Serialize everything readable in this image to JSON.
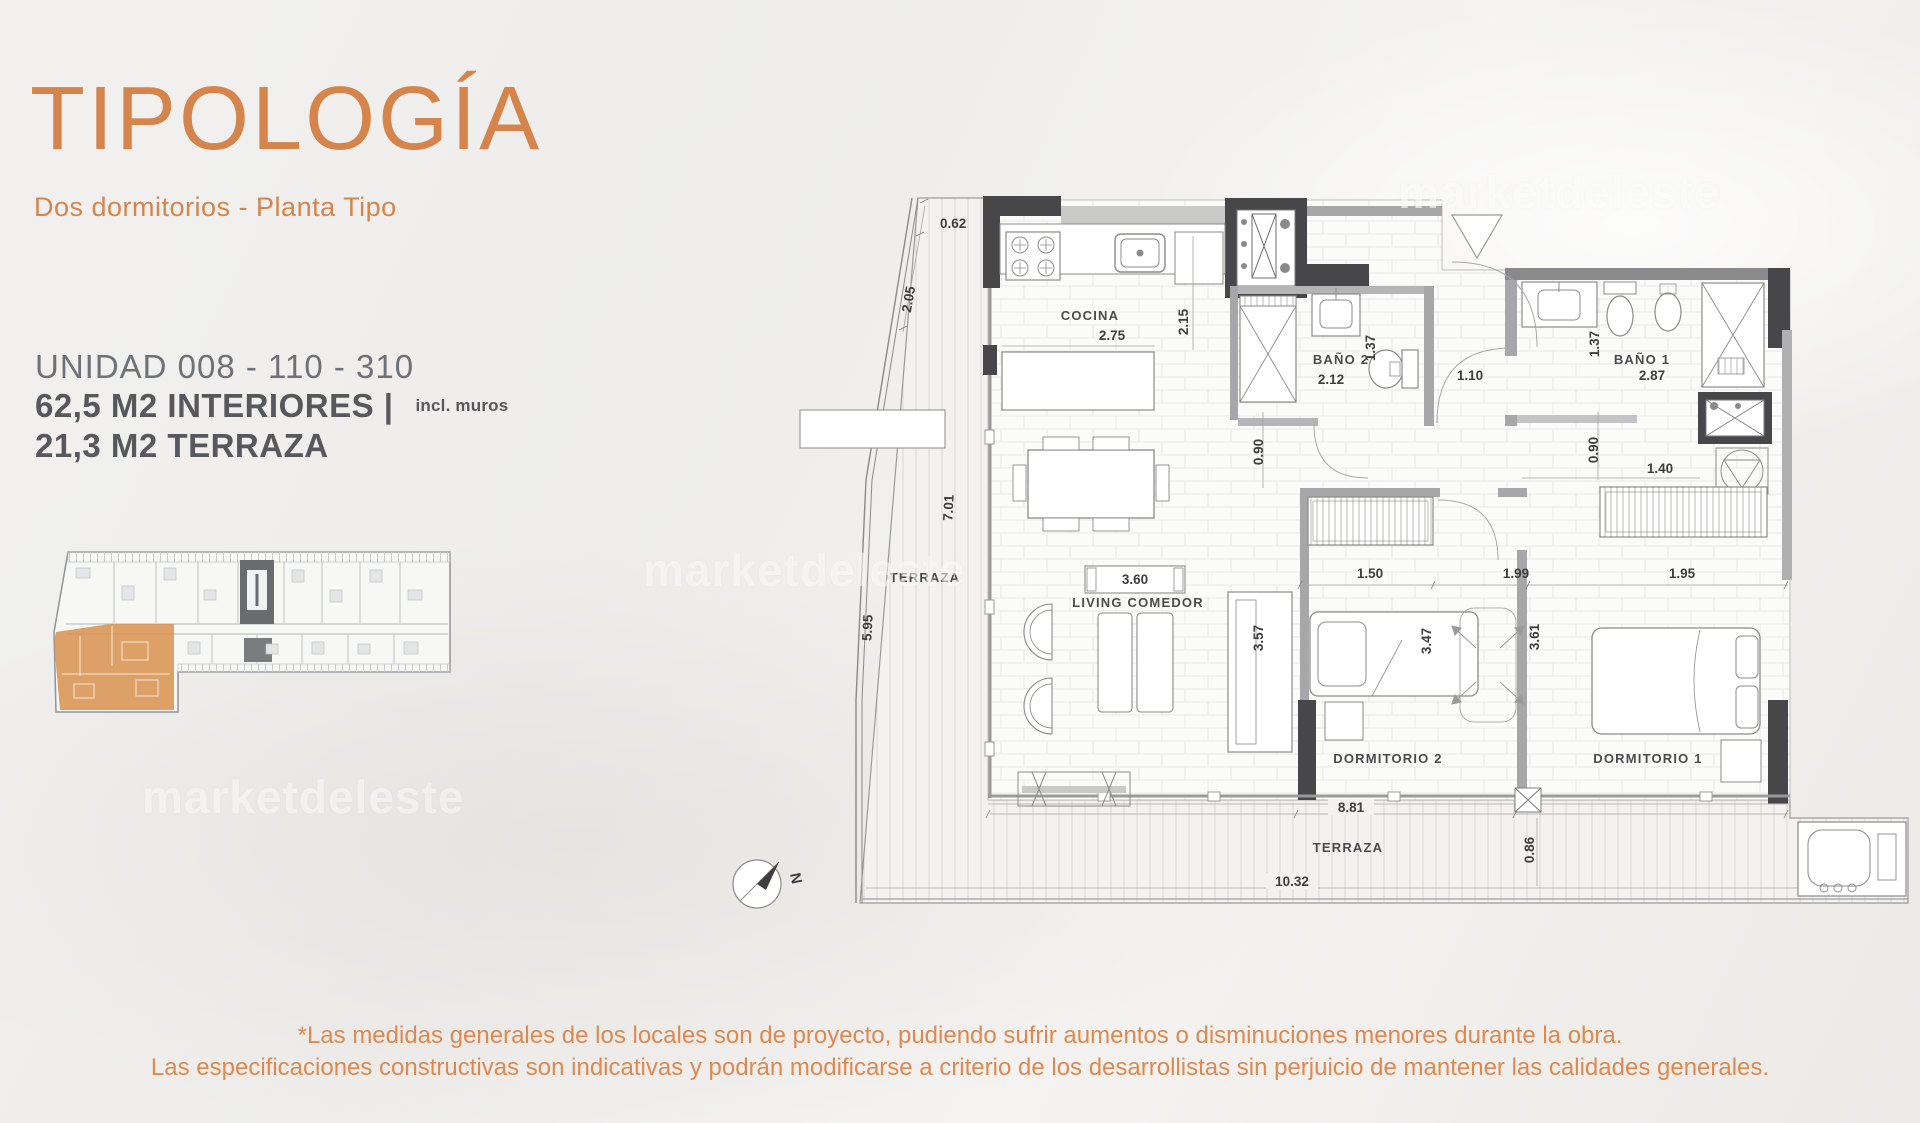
{
  "page": {
    "background": "#f0efec",
    "accent_orange": "#d5854b",
    "text_gray": "#6e7175",
    "bold_gray": "#57585b",
    "wall_dark": "#474749",
    "keyplan_highlight": "#d8914e"
  },
  "header": {
    "title": "TIPOLOGÍA",
    "subtitle": "Dos dormitorios - Planta Tipo"
  },
  "unit": {
    "name": "UNIDAD 008 - 110 - 310",
    "interior": "62,5 M2 INTERIORES |",
    "interior_note": "incl. muros",
    "terrace": "21,3 M2 TERRAZA"
  },
  "watermark": {
    "text": "marketdeleste"
  },
  "plan": {
    "rooms": {
      "cocina": "COCINA",
      "bano2": "BAÑO 2",
      "bano1": "BAÑO 1",
      "living": "LIVING COMEDOR",
      "terraza_left": "TERRAZA",
      "dorm2": "DORMITORIO 2",
      "dorm1": "DORMITORIO 1",
      "terraza_bottom": "TERRAZA"
    },
    "dims": {
      "d062": "0.62",
      "d205": "2.05",
      "d701": "7.01",
      "d595": "5.95",
      "d275": "2.75",
      "d215": "2.15",
      "d212": "2.12",
      "d137a": "1.37",
      "d110": "1.10",
      "d287": "2.87",
      "d137b": "1.37",
      "d090a": "0.90",
      "d090b": "0.90",
      "d140": "1.40",
      "d360": "3.60",
      "d150": "1.50",
      "d199": "1.99",
      "d195": "1.95",
      "d357": "3.57",
      "d347": "3.47",
      "d361": "3.61",
      "d881": "8.81",
      "d086": "0.86",
      "d125": "1.25",
      "d1032": "10.32"
    },
    "north": "N"
  },
  "disclaimer": {
    "line1": "*Las medidas generales de los locales son de proyecto, pudiendo sufrir aumentos o disminuciones menores durante la obra.",
    "line2": "Las especificaciones constructivas son indicativas y podrán modificarse a criterio de los desarrollistas sin perjuicio de mantener las calidades generales."
  }
}
